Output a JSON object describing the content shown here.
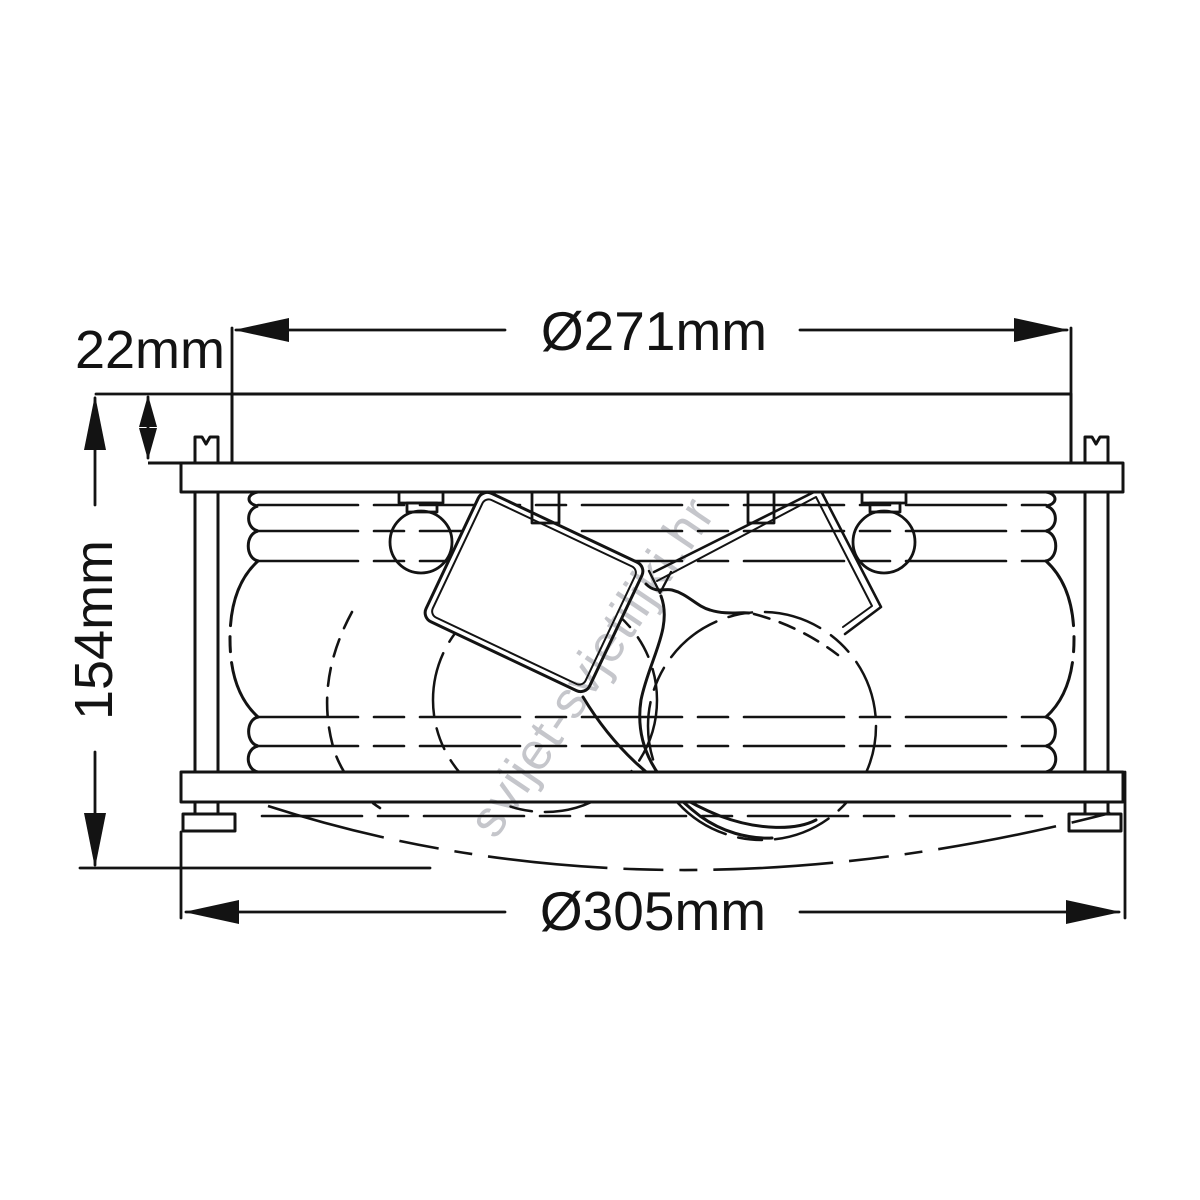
{
  "dimensions": {
    "top_diameter": "Ø271mm",
    "canopy_height": "22mm",
    "total_height": "154mm",
    "bottom_diameter": "Ø305mm"
  },
  "watermark": "svijet-svjetiljki.hr",
  "style": {
    "line_color": "#131313",
    "background": "#ffffff",
    "watermark_color": "#c5c6cb"
  }
}
